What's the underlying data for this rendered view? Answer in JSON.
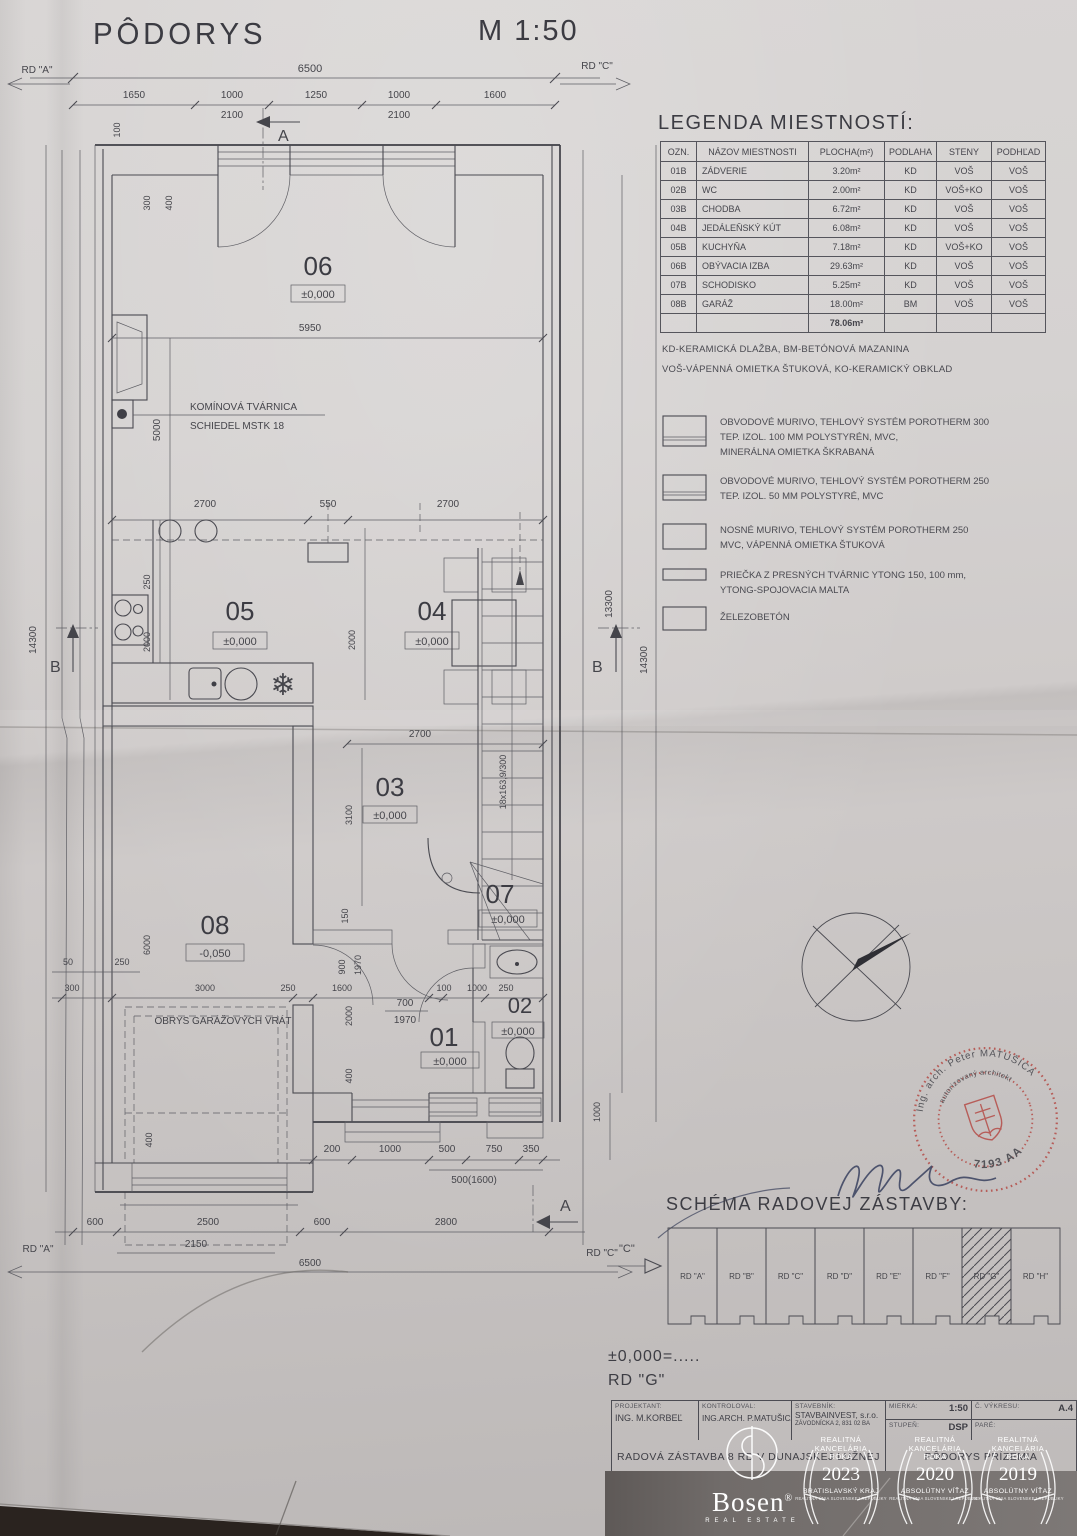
{
  "header": {
    "title": "PÔDORYS",
    "scale": "M 1:50"
  },
  "plan": {
    "markers": {
      "rd_a": "RD \"A\"",
      "rd_c": "RD \"C\"",
      "sec_a": "A",
      "sec_b": "B"
    },
    "rooms": {
      "r01": "01",
      "r02": "02",
      "r03": "03",
      "r04": "04",
      "r05": "05",
      "r06": "06",
      "r07": "07",
      "r08": "08"
    },
    "levels": {
      "zero": "±0,000",
      "minus": "-0,050"
    },
    "dims": {
      "50": "50",
      "100": "100",
      "150": "150",
      "200": "200",
      "250": "250",
      "300": "300",
      "350": "350",
      "400": "400",
      "500": "500",
      "550": "550",
      "600": "600",
      "700": "700",
      "750": "750",
      "900": "900",
      "1000": "1000",
      "1250": "1250",
      "1600": "1600",
      "1650": "1650",
      "1970": "1970",
      "2000": "2000",
      "2100": "2100",
      "2150": "2150",
      "2500": "2500",
      "2700": "2700",
      "2800": "2800",
      "3000": "3000",
      "3100": "3100",
      "5000": "5000",
      "5950": "5950",
      "6000": "6000",
      "6500": "6500",
      "13300": "13300",
      "14300": "14300",
      "5001600": "500(1600)",
      "stairs": "18x163,9/300"
    },
    "notes": {
      "chimney1": "KOMÍNOVÁ TVÁRNICA",
      "chimney2": "SCHIEDEL MSTK 18",
      "garage": "OBRYS GARÁŽOVÝCH VRÁT"
    }
  },
  "icons": {
    "freezer": "❄"
  },
  "legend": {
    "title": "LEGENDA MIESTNOSTÍ:",
    "headers": [
      "OZN.",
      "NÁZOV MIESTNOSTI",
      "PLOCHA(m²)",
      "PODLAHA",
      "STENY",
      "PODHĽAD"
    ],
    "rows": [
      [
        "01B",
        "ZÁDVERIE",
        "3.20m²",
        "KD",
        "VOŠ",
        "VOŠ"
      ],
      [
        "02B",
        "WC",
        "2.00m²",
        "KD",
        "VOŠ+KO",
        "VOŠ"
      ],
      [
        "03B",
        "CHODBA",
        "6.72m²",
        "KD",
        "VOŠ",
        "VOŠ"
      ],
      [
        "04B",
        "JEDÁLEŇSKÝ KÚT",
        "6.08m²",
        "KD",
        "VOŠ",
        "VOŠ"
      ],
      [
        "05B",
        "KUCHYŇA",
        "7.18m²",
        "KD",
        "VOŠ+KO",
        "VOŠ"
      ],
      [
        "06B",
        "OBÝVACIA IZBA",
        "29.63m²",
        "KD",
        "VOŠ",
        "VOŠ"
      ],
      [
        "07B",
        "SCHODISKO",
        "5.25m²",
        "KD",
        "VOŠ",
        "VOŠ"
      ],
      [
        "08B",
        "GARÁŽ",
        "18.00m²",
        "BM",
        "VOŠ",
        "VOŠ"
      ]
    ],
    "total": "78.06m²",
    "note1": "KD-KERAMICKÁ DLAŽBA, BM-BETÓNOVÁ MAZANINA",
    "note2": "VOŠ-VÁPENNÁ OMIETKA ŠTUKOVÁ, KO-KERAMICKÝ OBKLAD"
  },
  "materials": {
    "items": [
      {
        "l1": "OBVODOVÉ MURIVO, TEHLOVÝ SYSTÉM POROTHERM 300",
        "l2": "TEP. IZOL. 100 MM POLYSTYRÉN, MVC,",
        "l3": "MINERÁLNA OMIETKA ŠKRABANÁ"
      },
      {
        "l1": "OBVODOVÉ MURIVO, TEHLOVÝ SYSTÉM POROTHERM 250",
        "l2": "TEP. IZOL. 50 MM POLYSTYRÉ, MVC"
      },
      {
        "l1": "NOSNÉ MURIVO, TEHLOVÝ SYSTÉM POROTHERM 250",
        "l2": "MVC, VÁPENNÁ OMIETKA ŠTUKOVÁ"
      },
      {
        "l1": "PRIEČKA Z PRESNÝCH TVÁRNIC YTONG 150, 100 mm,",
        "l2": "YTONG-SPOJOVACIA MALTA"
      },
      {
        "l1": "ŽELEZOBETÓN"
      }
    ]
  },
  "stamp": {
    "arc_top": "Ing. arch. Peter MATUŠICA",
    "arc_inner": "autorizovaný architekt",
    "number": "7193 AA"
  },
  "schema": {
    "title": "SCHÉMA RADOVEJ ZÁSTAVBY:",
    "marker": "\"C\"",
    "units": [
      "RD \"A\"",
      "RD \"B\"",
      "RD \"C\"",
      "RD \"D\"",
      "RD \"E\"",
      "RD \"F\"",
      "RD \"G\"",
      "RD \"H\""
    ],
    "level_note": "±0,000=.....",
    "unit_note": "RD \"G\""
  },
  "titleblock": {
    "projektant_label": "PROJEKTANT:",
    "projektant": "ING. M.KORBEĽ",
    "kontroloval_label": "KONTROLOVAL:",
    "kontroloval": "ING.ARCH. P.MATUŠICA",
    "stavebnik_label": "STAVEBNÍK:",
    "stavebnik": "STAVBAINVEST, s.r.o.",
    "stavebnik_addr": "ZÁVODNÍCKA 2, 831 02 BA",
    "mierka_label": "MIERKA:",
    "mierka": "1:50",
    "vykres_label": "Č. VÝKRESU:",
    "vykres": "A.4",
    "stupen_label": "STUPEŇ:",
    "stupen": "DSP",
    "pare_label": "PARÉ:",
    "title_left": "RADOVÁ ZÁSTAVBA 8 RD V DUNAJSKEJ LUŽNEJ",
    "title_right": "PÔDORYS PRÍZEMIA"
  },
  "branding": {
    "logo": "Bosen",
    "reg": "®",
    "logo_sub": "REAL ESTATE",
    "badges": [
      {
        "line1": "REALITNÁ",
        "line2": "KANCELÁRIA",
        "line3": "ROKA",
        "year": "2023",
        "subtitle": "BRATISLAVSKÝ KRAJ",
        "fine": "REALITNÁ ÚNIA SLOVENSKEJ REPUBLIKY"
      },
      {
        "line1": "REALITNÁ",
        "line2": "KANCELÁRIA",
        "line3": "ROKA",
        "year": "2020",
        "subtitle": "ABSOLÚTNY VÍŤAZ",
        "fine": "REALITNÁ ÚNIA SLOVENSKEJ REPUBLIKY"
      },
      {
        "line1": "REALITNÁ",
        "line2": "KANCELÁRIA",
        "line3": "ROKA",
        "year": "2019",
        "subtitle": "ABSOLÚTNY VÍŤAZ",
        "fine": "REALITNÁ ÚNIA SLOVENSKEJ REPUBLIKY"
      }
    ]
  },
  "colors": {
    "line": "#4a4a51",
    "stamp_red": "#b5504b",
    "signature_ink": "#3f4764",
    "paper": "#d0cccb"
  }
}
